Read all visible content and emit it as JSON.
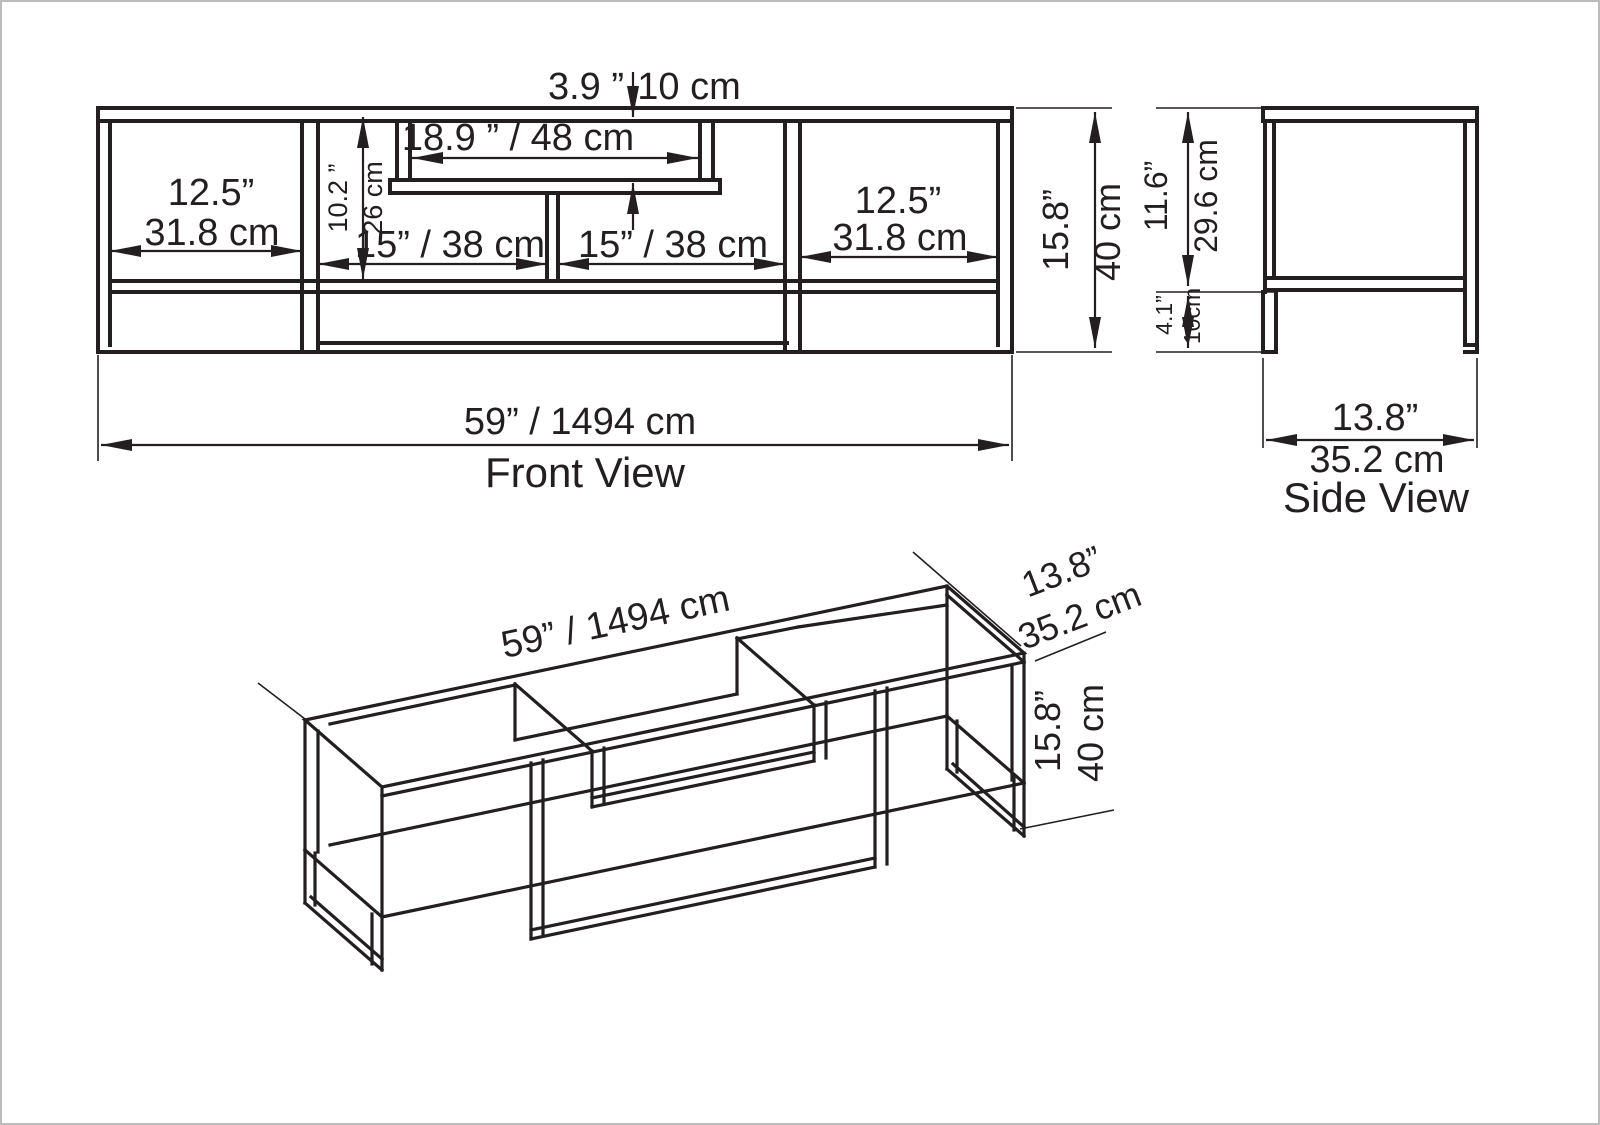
{
  "front_view": {
    "label": "Front View",
    "overall_width": "59” / 1494 cm",
    "recess_depth_in": "3.9 ”",
    "recess_depth_cm": "10 cm",
    "tv_opening_width": "18.9 ” / 48 cm",
    "opening_height_in": "10.2 ”",
    "opening_height_cm": "26 cm",
    "left_compartment_in": "12.5”",
    "left_compartment_cm": "31.8 cm",
    "middle_left_section": "15” / 38 cm",
    "middle_right_section": "15” / 38 cm",
    "right_compartment_in": "12.5”",
    "right_compartment_cm": "31.8 cm",
    "overall_height_in": "15.8”",
    "overall_height_cm": "40 cm"
  },
  "side_view": {
    "label": "Side View",
    "body_height_in": "11.6”",
    "body_height_cm": "29.6 cm",
    "leg_height_in": "4.1”",
    "leg_height_cm": "10cm",
    "depth_in": "13.8”",
    "depth_cm": "35.2 cm"
  },
  "iso_view": {
    "overall_width": "59” / 1494 cm",
    "depth_in": "13.8”",
    "depth_cm": "35.2 cm",
    "height_in": "15.8”",
    "height_cm": "40 cm"
  },
  "colors": {
    "line": "#231f20",
    "background": "#ffffff"
  }
}
